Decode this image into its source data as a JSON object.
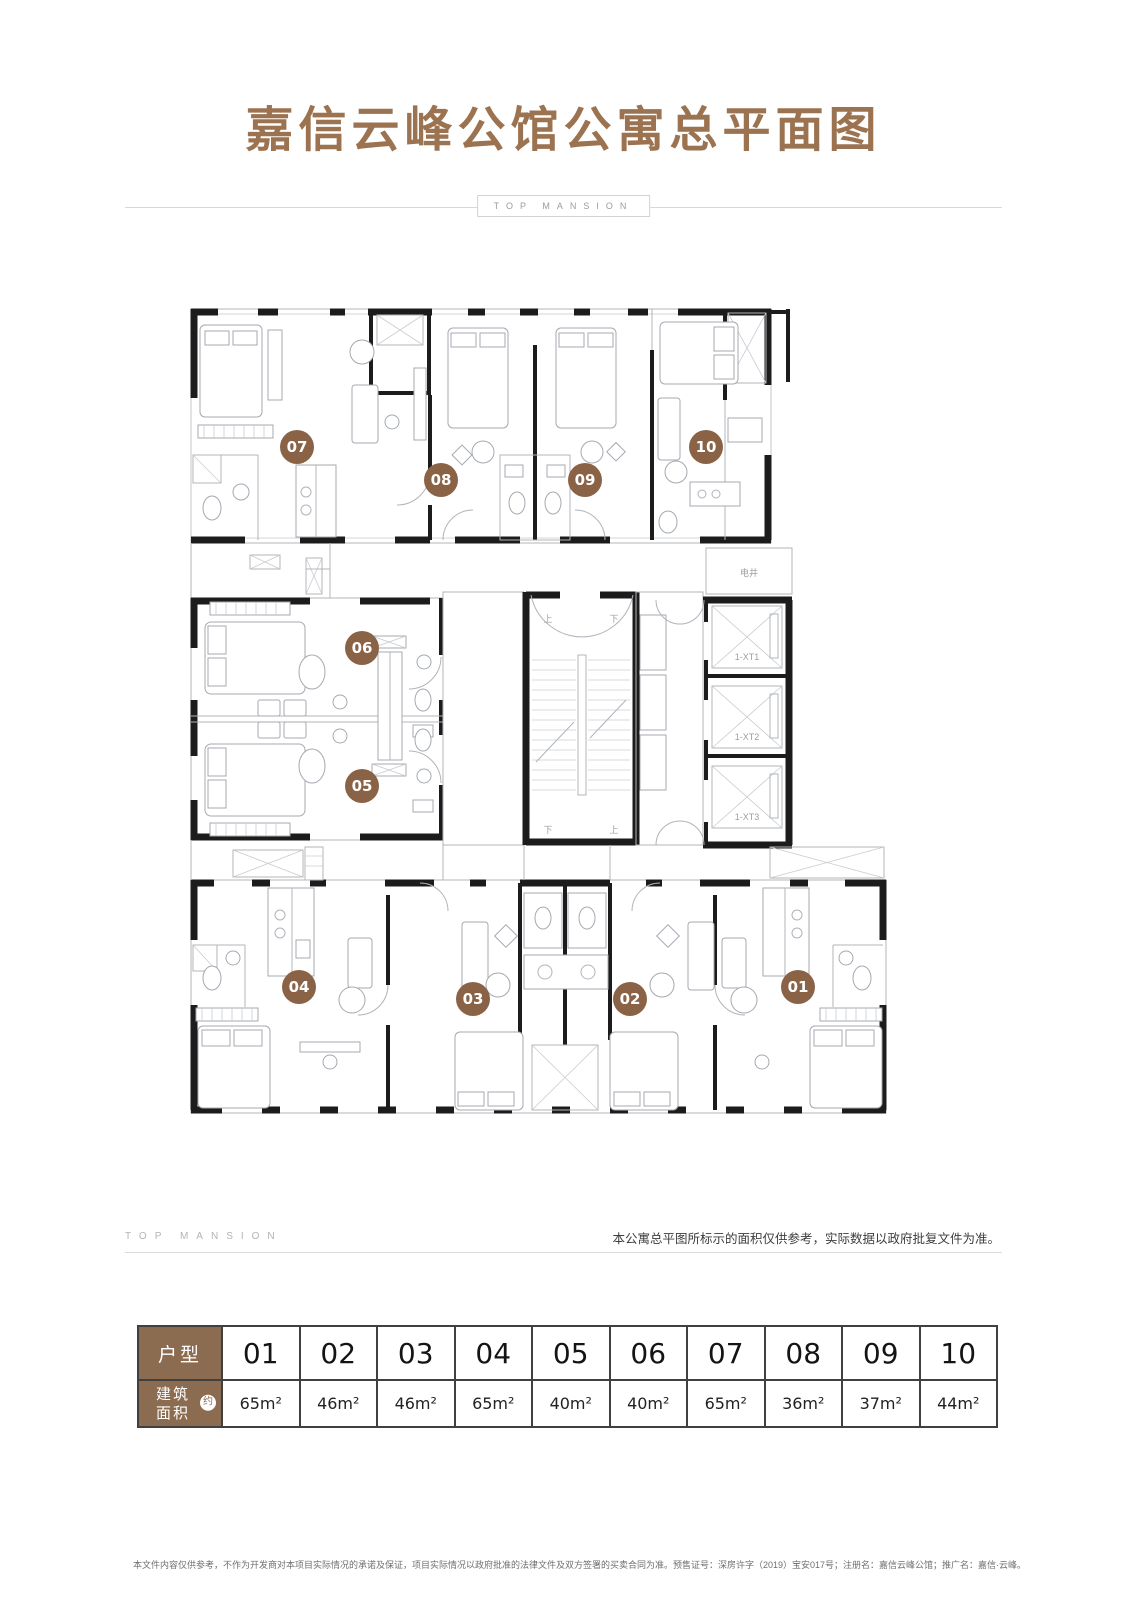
{
  "page_title": "嘉信云峰公馆公寓总平面图",
  "brand": {
    "top": "TOP MANSION",
    "bottom": "TOP MANSION"
  },
  "disclaimer": "本公寓总平图所标示的面积仅供参考，实际数据以政府批复文件为准。",
  "footnote": "本文件内容仅供参考，不作为开发商对本项目实际情况的承诺及保证，项目实际情况以政府批准的法律文件及双方签署的买卖合同为准。预售证号：深房许字（2019）宝安017号；注册名：嘉信云峰公馆；推广名：嘉信·云峰。",
  "floorplan": {
    "units": [
      "07",
      "08",
      "09",
      "10",
      "06",
      "05",
      "04",
      "03",
      "02",
      "01"
    ],
    "labels": {
      "shaft": "电井",
      "up": "上",
      "down": "下",
      "elevator1": "1-XT1",
      "elevator2": "1-XT2",
      "elevator3": "1-XT3"
    }
  },
  "table": {
    "row1_header": "户型",
    "row2_header_l1": "建筑",
    "row2_header_l2": "面积",
    "approx_badge": "约",
    "units": [
      "01",
      "02",
      "03",
      "04",
      "05",
      "06",
      "07",
      "08",
      "09",
      "10"
    ],
    "areas": [
      "65m²",
      "46m²",
      "46m²",
      "65m²",
      "40m²",
      "40m²",
      "65m²",
      "36m²",
      "37m²",
      "44m²"
    ]
  },
  "colors": {
    "brand_brown": "#9c7350",
    "marker_brown": "#8a6347",
    "table_header_brown": "#8c6c50",
    "wall_black": "#1c1c1c",
    "divider_gray": "#d8d8d8"
  }
}
